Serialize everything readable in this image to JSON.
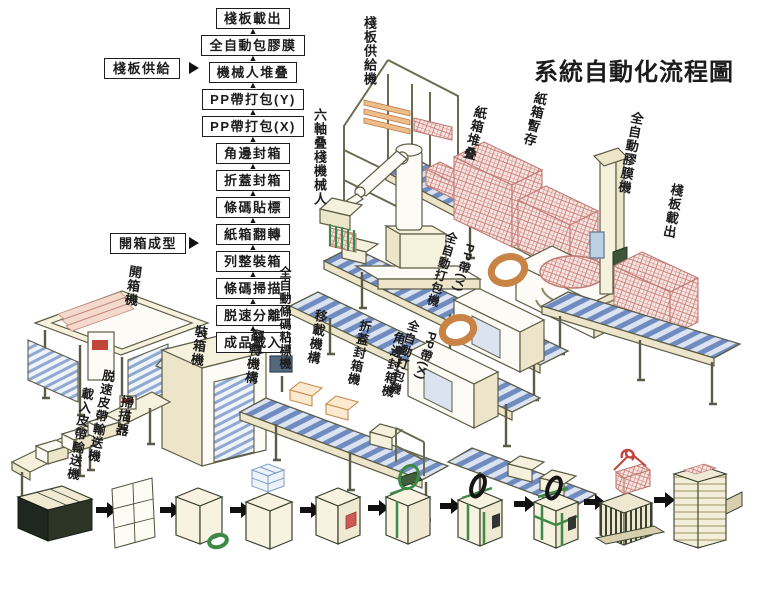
{
  "title": "系統自動化流程圖",
  "flowchart": {
    "steps": [
      "棧板載出",
      "全自動包膠膜",
      "機械人堆叠",
      "PP帶打包(Y)",
      "PP帶打包(X)",
      "角邊封箱",
      "折蓋封箱",
      "條碼貼標",
      "紙箱翻轉",
      "列整裝箱",
      "條碼掃描",
      "脱速分離",
      "成品載入"
    ],
    "inputs": [
      {
        "label": "棧板供給",
        "feeds_step": "機械人堆叠"
      },
      {
        "label": "開箱成型",
        "feeds_step": "列整裝箱"
      }
    ]
  },
  "machine_labels": [
    {
      "id": "pallet-supply-machine",
      "text": "棧板供給機"
    },
    {
      "id": "six-axis-palletizing-robot",
      "text": "六軸叠棧機械人"
    },
    {
      "id": "carton-stacking",
      "text": "紙箱堆叠"
    },
    {
      "id": "carton-buffer",
      "text": "紙箱暫存"
    },
    {
      "id": "auto-stretch-wrapper",
      "text": "全自動膠膜機"
    },
    {
      "id": "pallet-unload",
      "text": "棧板載出"
    },
    {
      "id": "auto-strapper-y",
      "text": "全自動打包機"
    },
    {
      "id": "pp-band-y",
      "text": "PP帶(Y)"
    },
    {
      "id": "auto-strapper-x",
      "text": "全自動打包機"
    },
    {
      "id": "pp-band-x",
      "text": "PP帶(X)"
    },
    {
      "id": "corner-edge-sealer",
      "text": "角邊封箱機"
    },
    {
      "id": "flap-fold-sealer",
      "text": "折蓋封箱機"
    },
    {
      "id": "transfer-mechanism",
      "text": "移載機構"
    },
    {
      "id": "auto-barcode-labeler",
      "text": "全自動條碼粘標機"
    },
    {
      "id": "turnover-mechanism",
      "text": "翻轉機構"
    },
    {
      "id": "case-packer",
      "text": "裝箱機"
    },
    {
      "id": "case-erector",
      "text": "開箱機"
    },
    {
      "id": "scanner",
      "text": "掃描器"
    },
    {
      "id": "speed-release-belt-conveyor",
      "text": "脱速皮帶輸送機"
    },
    {
      "id": "infeed-belt-conveyor",
      "text": "載入皮帶輸送機"
    }
  ],
  "process_stages": [
    {
      "name": "stacked-carton-blanks"
    },
    {
      "name": "carton-blank"
    },
    {
      "name": "erected-carton-taping"
    },
    {
      "name": "product-case-loading"
    },
    {
      "name": "sealed-case-labeled"
    },
    {
      "name": "case-strapping"
    },
    {
      "name": "strapped-case-x"
    },
    {
      "name": "strapped-case-xy"
    },
    {
      "name": "robot-palletizing"
    },
    {
      "name": "wrapped-pallet-output"
    }
  ],
  "colors": {
    "machine_line": "#5c5c46",
    "machine_fill": "#f6f1dd",
    "conveyor_blue": "#6f8bc0",
    "carton_red": "#cf8680",
    "strap_green": "#3c8a46",
    "reel_orange": "#c98445",
    "arrow_black": "#111111"
  }
}
